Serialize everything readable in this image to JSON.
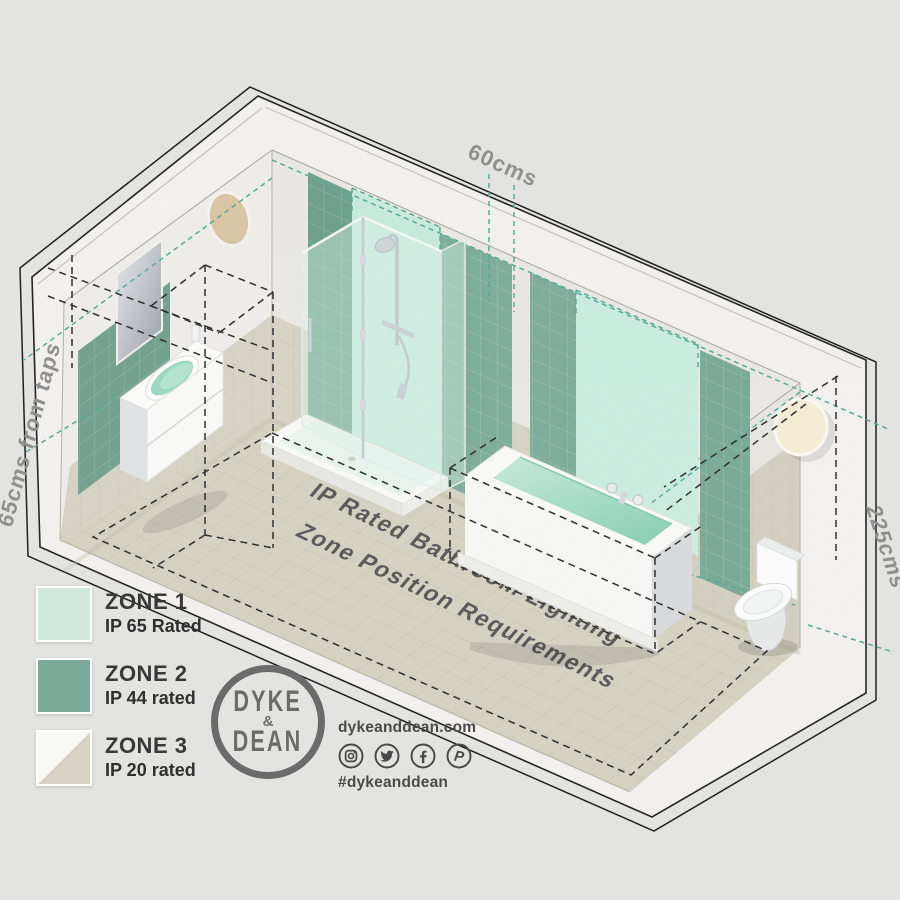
{
  "scene": {
    "title_context": "IP rated bathroom lighting zone diagram",
    "dimension_labels": {
      "top": "60cms",
      "left": "65cms from taps",
      "right": "225cms"
    },
    "floor_text": {
      "line1": "IP Rated Bathroom Lighting",
      "line2": "Zone Position Requirements"
    },
    "fixtures": [
      "sink-vanity",
      "mirror",
      "shower-enclosure",
      "bathtub",
      "toilet",
      "wall-light-left",
      "wall-light-right"
    ]
  },
  "legend": {
    "items": [
      {
        "label": "ZONE 1",
        "rating": "IP 65 Rated",
        "color": "#cfe9df"
      },
      {
        "label": "ZONE 2",
        "rating": "IP 44 rated",
        "color": "#7cab99"
      },
      {
        "label": "ZONE 3",
        "rating": "IP 20 rated",
        "color_top": "#f8f8f6",
        "color_bottom": "#d8d3c4"
      }
    ]
  },
  "brand": {
    "logo_line1": "DYKE",
    "logo_amp": "&",
    "logo_line2": "DEAN",
    "website": "dykeanddean.com",
    "hashtag": "#dykeanddean",
    "social_icons": [
      "instagram",
      "twitter",
      "facebook",
      "pinterest"
    ]
  },
  "colors": {
    "background": "#e3e4e2",
    "zone1_mint": "#cdeee2",
    "zone2_green": "#7cab99",
    "zone3_beige": "#d8d3c4",
    "teal_dash": "#57ac98",
    "black_dash": "#2e2e2e",
    "floor": "#d8d4c4",
    "wall_tile": "#d9d5c6",
    "plaster": "#efeeea",
    "brand_gray": "#6b6b6b",
    "text_dark": "#383838"
  }
}
